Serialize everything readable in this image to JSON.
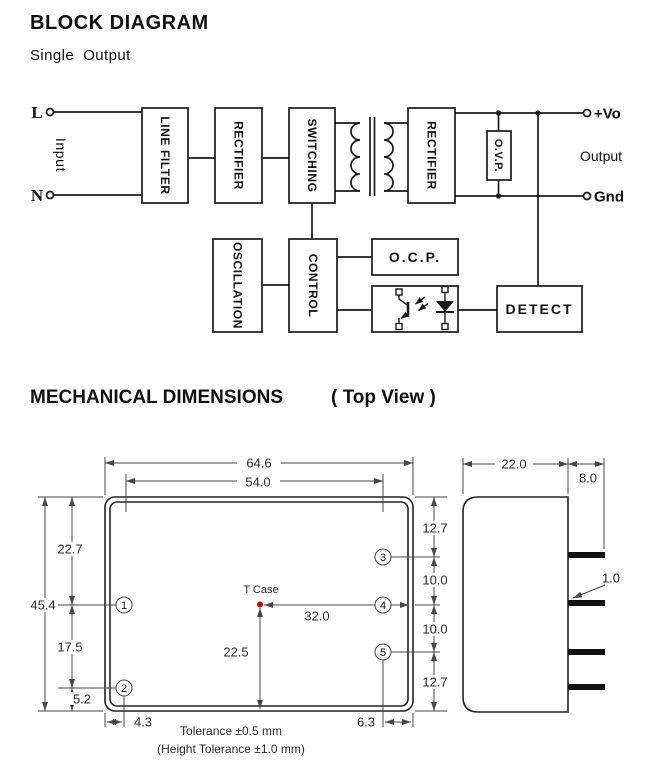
{
  "colors": {
    "ink": "#1a1a1a",
    "dim": "#474747",
    "red": "#cc0000"
  },
  "block": {
    "title": "BLOCK DIAGRAM",
    "subtitle": "Single  Output",
    "terminals": {
      "l": "L",
      "n": "N",
      "input": "Input",
      "vo": "+Vo",
      "output": "Output",
      "gnd": "Gnd"
    },
    "boxes": {
      "line_filter": "LINE FILTER",
      "rectifier_in": "RECTIFIER",
      "switching": "SWITCHING",
      "rectifier_out": "RECTIFIER",
      "ovp": "O.V.P.",
      "oscillation": "OSCILLATION",
      "control": "CONTROL",
      "ocp": "O.C.P.",
      "detect": "DETECT"
    }
  },
  "mech": {
    "title": "MECHANICAL DIMENSIONS",
    "view_label": "( Top View )",
    "top_view": {
      "width_outer": "64.6",
      "width_pins": "54.0",
      "height_total": "45.4",
      "pin1_from_top": "22.7",
      "pin1_to_pin2": "17.5",
      "pin2_from_bottom": "5.2",
      "pin_inset_left": "4.3",
      "pin_inset_right": "6.3",
      "pin3_from_top": "12.7",
      "pin3_to_pin4": "10.0",
      "pin4_to_pin5": "10.0",
      "pin5_from_bottom": "12.7",
      "tcase_label": "T Case",
      "tcase_from_right": "32.0",
      "tcase_from_bottom": "22.5",
      "pins": [
        "1",
        "2",
        "3",
        "4",
        "5"
      ]
    },
    "side_view": {
      "depth": "22.0",
      "pin_length": "8.0",
      "pin_thickness": "1.0"
    },
    "tolerance_line1": "Tolerance ±0.5 mm",
    "tolerance_line2": "(Height Tolerance ±1.0 mm)"
  }
}
